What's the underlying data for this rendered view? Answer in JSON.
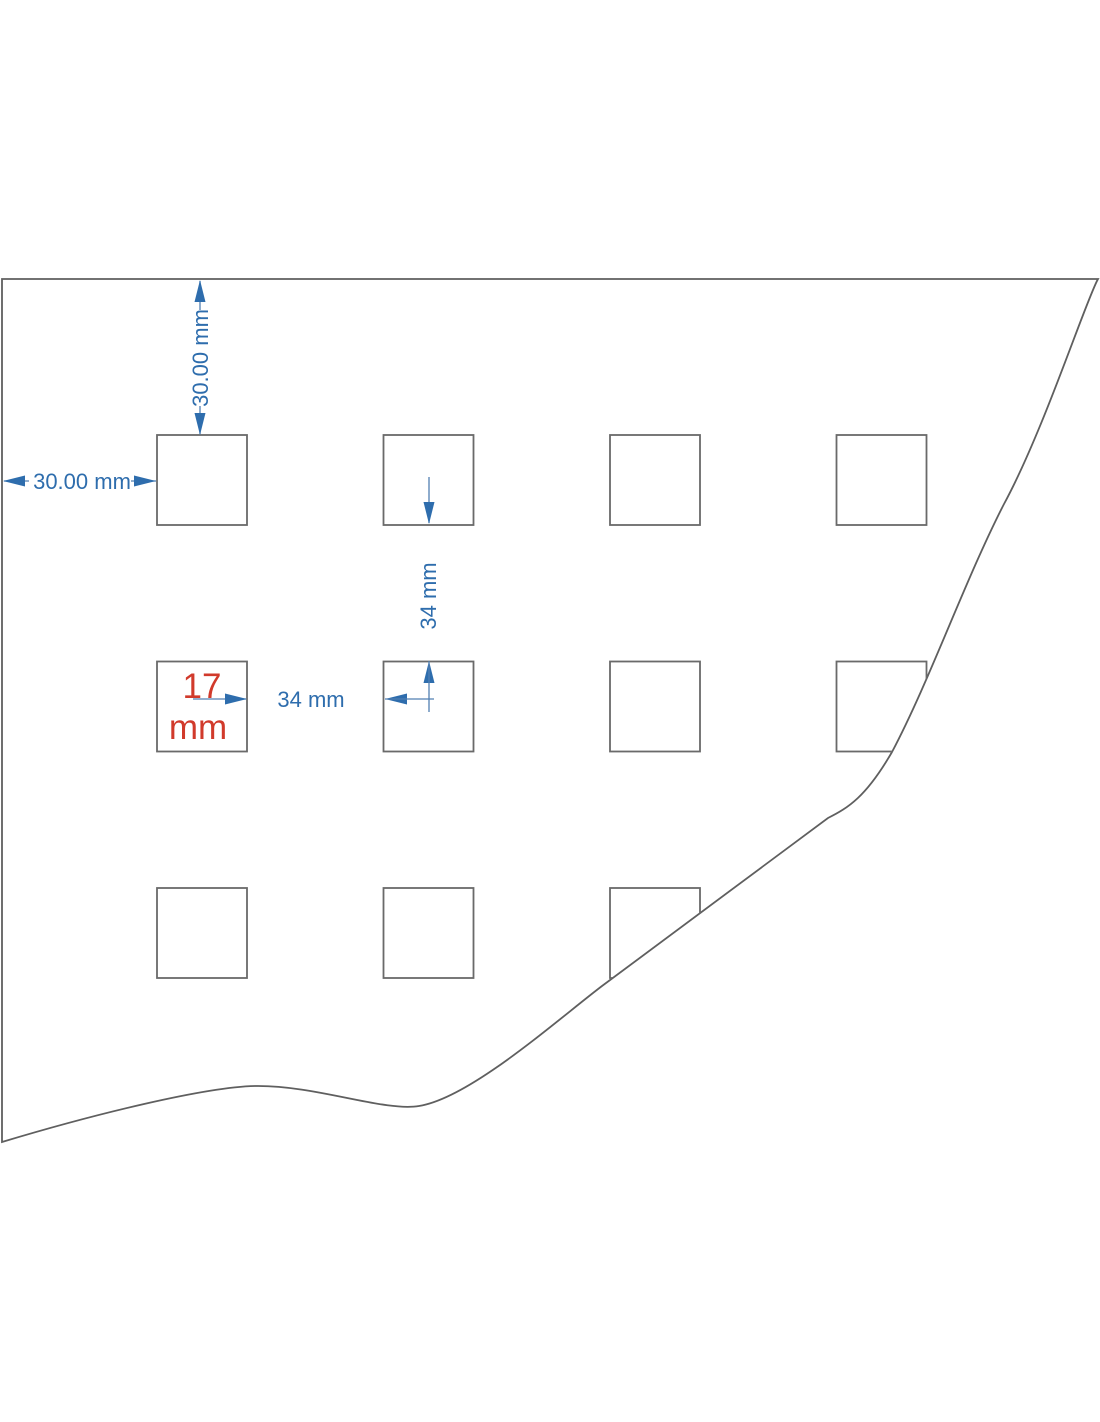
{
  "diagram": {
    "type": "technical-drawing",
    "description": "Perforated sheet with square holes, torn edge, dimension annotations",
    "labels": {
      "top_margin": "30.00 mm",
      "left_margin": "30.00 mm",
      "vertical_spacing": "34 mm",
      "horizontal_spacing": "34 mm",
      "hole_size_line1": "17",
      "hole_size_line2": "mm"
    },
    "colors": {
      "dimension_blue": "#2e6dad",
      "dimension_line_blue": "#507fb2",
      "hole_size_red": "#d13a2b",
      "sheet_edge_gray": "#5f5f5f",
      "hole_stroke_gray": "#6a6a6a",
      "background": "#ffffff"
    },
    "grid": {
      "rows": 3,
      "columns": 4,
      "visible_holes": 11,
      "origin_x": 157,
      "origin_y": 435,
      "pitch_x": 226.5,
      "pitch_y": 226.5,
      "hole_px": 90
    }
  }
}
